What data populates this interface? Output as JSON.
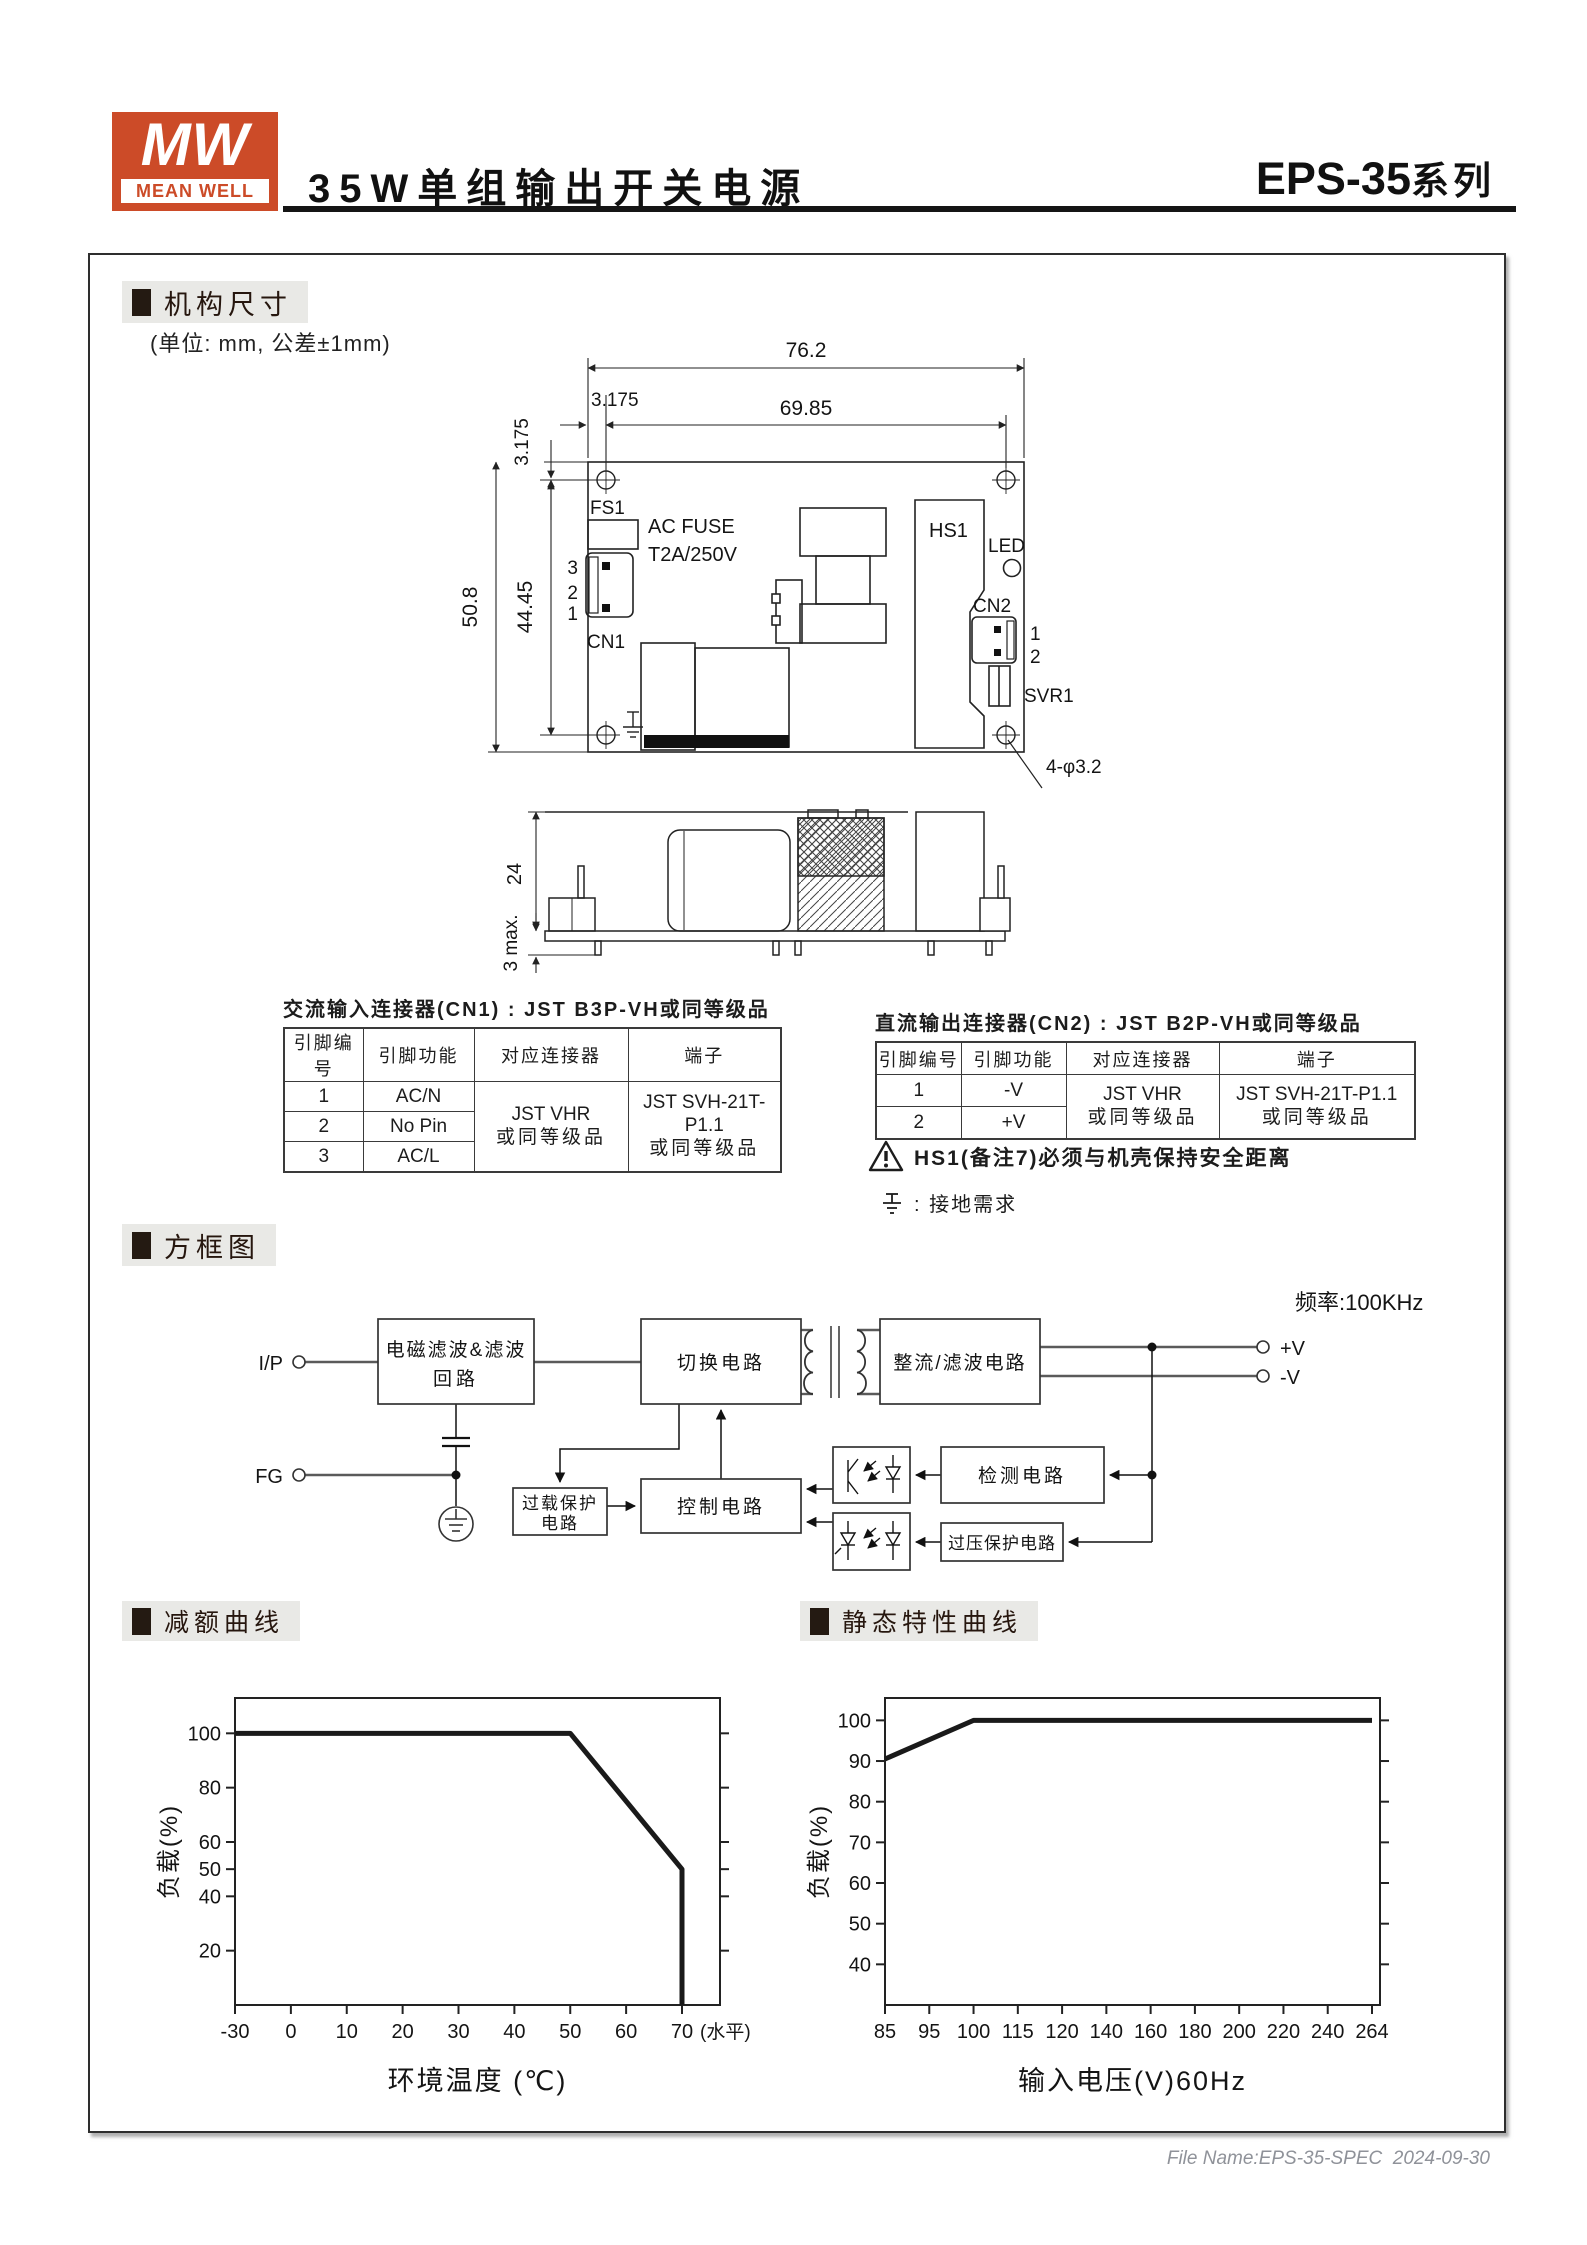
{
  "header": {
    "logo_mw": "MW",
    "logo_name": "MEAN WELL",
    "title": "35W单组输出开关电源",
    "series": "EPS-35",
    "series_suffix": "系列"
  },
  "sections": {
    "mech": "机构尺寸",
    "unit_note": "(单位: mm, 公差±1mm)",
    "block": "方框图",
    "derating": "减额曲线",
    "static_curve": "静态特性曲线"
  },
  "mech": {
    "dim_width": "76.2",
    "dim_offset_h": "3.175",
    "dim_inner": "69.85",
    "dim_offset_v": "3.175",
    "dim_height": "50.8",
    "dim_inner_v": "44.45",
    "fs1": "FS1",
    "fuse_line1": "AC FUSE",
    "fuse_line2": "T2A/250V",
    "cn1_pin3": "3",
    "cn1_pin2": "2",
    "cn1_pin1": "1",
    "cn1": "CN1",
    "hs1": "HS1",
    "led": "LED",
    "cn2": "CN2",
    "cn2_pin1": "1",
    "cn2_pin2": "2",
    "svr1": "SVR1",
    "holes": "4-φ3.2",
    "dim_depth": "24",
    "dim_pins": "3 max."
  },
  "cn1_table": {
    "title": "交流输入连接器(CN1) : JST B3P-VH或同等级品",
    "headers": [
      "引脚编号",
      "引脚功能",
      "对应连接器",
      "端子"
    ],
    "rows": [
      {
        "pin": "1",
        "func": "AC/N"
      },
      {
        "pin": "2",
        "func": "No Pin"
      },
      {
        "pin": "3",
        "func": "AC/L"
      }
    ],
    "connector_line1": "JST VHR",
    "connector_line2": "或同等级品",
    "terminal_line1": "JST SVH-21T-P1.1",
    "terminal_line2": "或同等级品"
  },
  "cn2_table": {
    "title": "直流输出连接器(CN2) : JST B2P-VH或同等级品",
    "headers": [
      "引脚编号",
      "引脚功能",
      "对应连接器",
      "端子"
    ],
    "rows": [
      {
        "pin": "1",
        "func": "-V"
      },
      {
        "pin": "2",
        "func": "+V"
      }
    ],
    "connector_line1": "JST VHR",
    "connector_line2": "或同等级品",
    "terminal_line1": "JST SVH-21T-P1.1",
    "terminal_line2": "或同等级品"
  },
  "notes": {
    "hs1_warning": "HS1(备注7)必须与机壳保持安全距离",
    "ground": ": 接地需求"
  },
  "block_diagram": {
    "frequency": "频率:100KHz",
    "input": "I/P",
    "fg": "FG",
    "emi_filter_line1": "电磁滤波&滤波",
    "emi_filter_line2": "回路",
    "switching": "切换电路",
    "rectifier": "整流/滤波电路",
    "v_plus": "+V",
    "v_minus": "-V",
    "detection": "检测电路",
    "ovp": "过压保护电路",
    "olp_line1": "过载保护",
    "olp_line2": "电路",
    "control": "控制电路"
  },
  "chart_data": [
    {
      "type": "line",
      "title": "减额曲线",
      "xlabel": "环境温度 (℃)",
      "ylabel": "负载(%)",
      "x_tick_labels": [
        "-30",
        "0",
        "10",
        "20",
        "30",
        "40",
        "50",
        "60",
        "70"
      ],
      "x_axis_note": "(水平)",
      "y_ticks": [
        20,
        40,
        50,
        60,
        80,
        100
      ],
      "y_range": [
        0,
        113
      ],
      "grid": false,
      "legend": false,
      "points": [
        {
          "temp_c": -30,
          "load_pct": 100
        },
        {
          "temp_c": 50,
          "load_pct": 100
        },
        {
          "temp_c": 70,
          "load_pct": 50
        },
        {
          "temp_c": 70,
          "load_pct": 0
        }
      ],
      "render_curve": [
        {
          "xi": 0,
          "v": 100
        },
        {
          "xi": 6,
          "v": 100
        },
        {
          "xi": 8,
          "v": 50
        },
        {
          "xi": 8,
          "v": 0
        }
      ]
    },
    {
      "type": "line",
      "title": "静态特性曲线",
      "xlabel": "输入电压(V)60Hz",
      "ylabel": "负载(%)",
      "x_tick_labels": [
        "85",
        "95",
        "100",
        "115",
        "120",
        "140",
        "160",
        "180",
        "200",
        "220",
        "240",
        "264"
      ],
      "y_ticks": [
        40,
        50,
        60,
        70,
        80,
        90,
        100
      ],
      "y_range": [
        30,
        105.5
      ],
      "grid": false,
      "legend": false,
      "points": [
        {
          "vin": 85,
          "load_pct": 90
        },
        {
          "vin": 100,
          "load_pct": 100
        },
        {
          "vin": 264,
          "load_pct": 100
        }
      ],
      "render_curve": [
        {
          "xi": 0,
          "v": 90.5
        },
        {
          "xi": 2,
          "v": 100
        },
        {
          "xi": 11,
          "v": 100
        }
      ]
    }
  ],
  "footer": {
    "file_name": "File Name:EPS-35-SPEC  2024-09-30"
  },
  "colors": {
    "brand_red": "#cc4b28",
    "curve_line": "#1a1a1a",
    "section_bg": "#e9e9e6",
    "footer_text": "#8f9299"
  }
}
